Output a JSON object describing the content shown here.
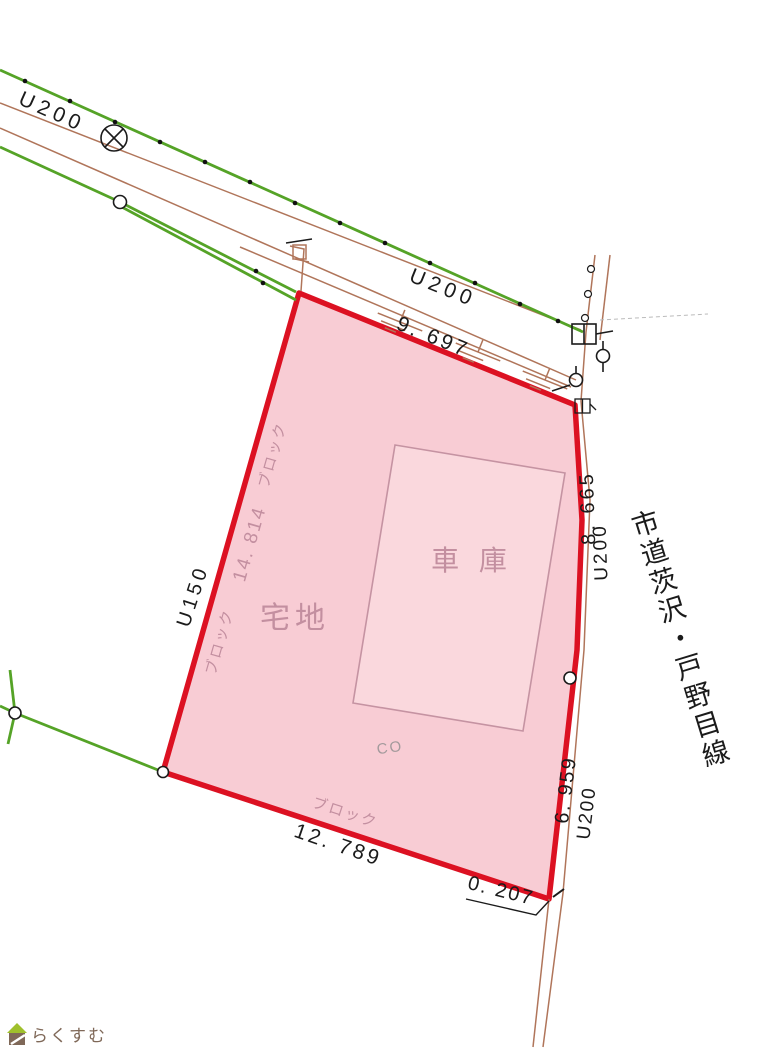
{
  "labels": {
    "u200_top_left": "U200",
    "u200_top_mid": "U200",
    "u200_right_upper": "U200",
    "u200_right_lower": "U200",
    "u150_left": "U150",
    "road_name": "市道茨沢・戸野目線",
    "dim_top": "9. 697",
    "dim_right_upper": "8. 665",
    "dim_right_lower": "6. 959",
    "dim_bottom": "12. 789",
    "dim_corner": "0. 207",
    "dim_left": "14. 814",
    "land_use": "宅地",
    "building": "車 庫",
    "surface": "CO",
    "fence_1": "ブロック",
    "fence_2": "ブロック",
    "fence_3": "ブロック"
  },
  "logo": {
    "text": "らくすむ"
  },
  "colors": {
    "parcel_outline": "#dc1122",
    "parcel_fill": "#f8ccd4",
    "garage_outline": "#c593a2",
    "garage_fill": "#fad8dd",
    "boundary_green": "#55a327",
    "road_brown": "#b0755a",
    "annotation_pink": "#c38fa0",
    "surface_gray": "#a39a9c",
    "text_black": "#1b1b1b",
    "logo_brown": "#7f6858",
    "logo_roof_green": "#9fc02c"
  },
  "symbols": {
    "utility_pole": "circle-with-cross",
    "boundary_point": "small-circle",
    "valve": "circle-with-stem",
    "meter_box": "divided-square",
    "slope_hatch": "stepped-lines"
  }
}
